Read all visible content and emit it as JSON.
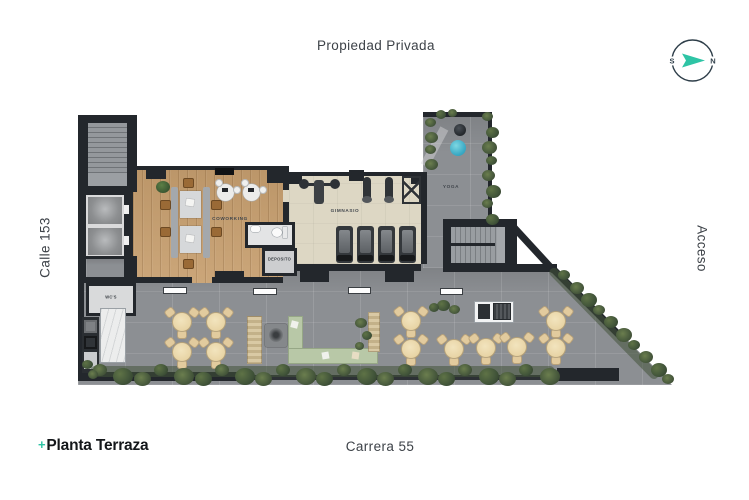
{
  "streets": {
    "top": "Propiedad Privada",
    "left": "Calle 153",
    "right": "Acceso",
    "bottom": "Carrera 55"
  },
  "title_block": {
    "plus": "+",
    "title": "Planta Terraza"
  },
  "compass": {
    "left_letter": "S",
    "right_letter": "N",
    "arrow_color": "#2ec4a5",
    "ring_color": "#2e3e49"
  },
  "rooms": {
    "coworking": "COWORKING",
    "gym": "GIMNASIO",
    "yoga": "YOGA",
    "storage": "DEPOSITO",
    "wc": "WC'S"
  },
  "colors": {
    "accent_teal": "#2ec4a5",
    "wall_dark": "#23272c",
    "wood_floor": "#c79f6f",
    "gym_floor": "#ddd7c4",
    "concrete": "#8c8f93",
    "plant_green": "#4a5c3e",
    "table_cream": "#eddcb2",
    "pouf_teal": "#3aa9c4"
  }
}
